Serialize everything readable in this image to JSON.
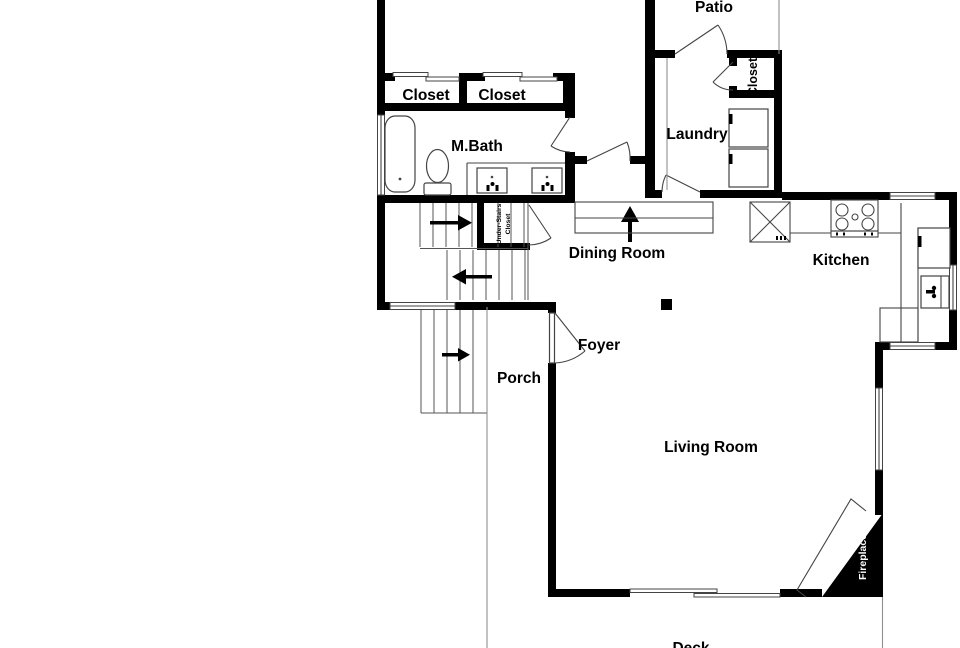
{
  "plan": {
    "title": "First floor plan",
    "rooms": {
      "patio": "Patio",
      "closet1": "Closet",
      "closet2": "Closet",
      "mbath": "M.Bath",
      "laundry": "Laundry",
      "laundry_closet": "Closet",
      "under_stairs_1": "Under-Stairs",
      "under_stairs_2": "Closet",
      "dining": "Dining Room",
      "kitchen": "Kitchen",
      "foyer": "Foyer",
      "porch": "Porch",
      "living": "Living Room",
      "fireplace": "Fireplace",
      "deck": "Deck"
    },
    "colors": {
      "wall": "#000000",
      "line": "#444444",
      "background": "#ffffff",
      "fireplace_text": "#ffffff"
    }
  }
}
